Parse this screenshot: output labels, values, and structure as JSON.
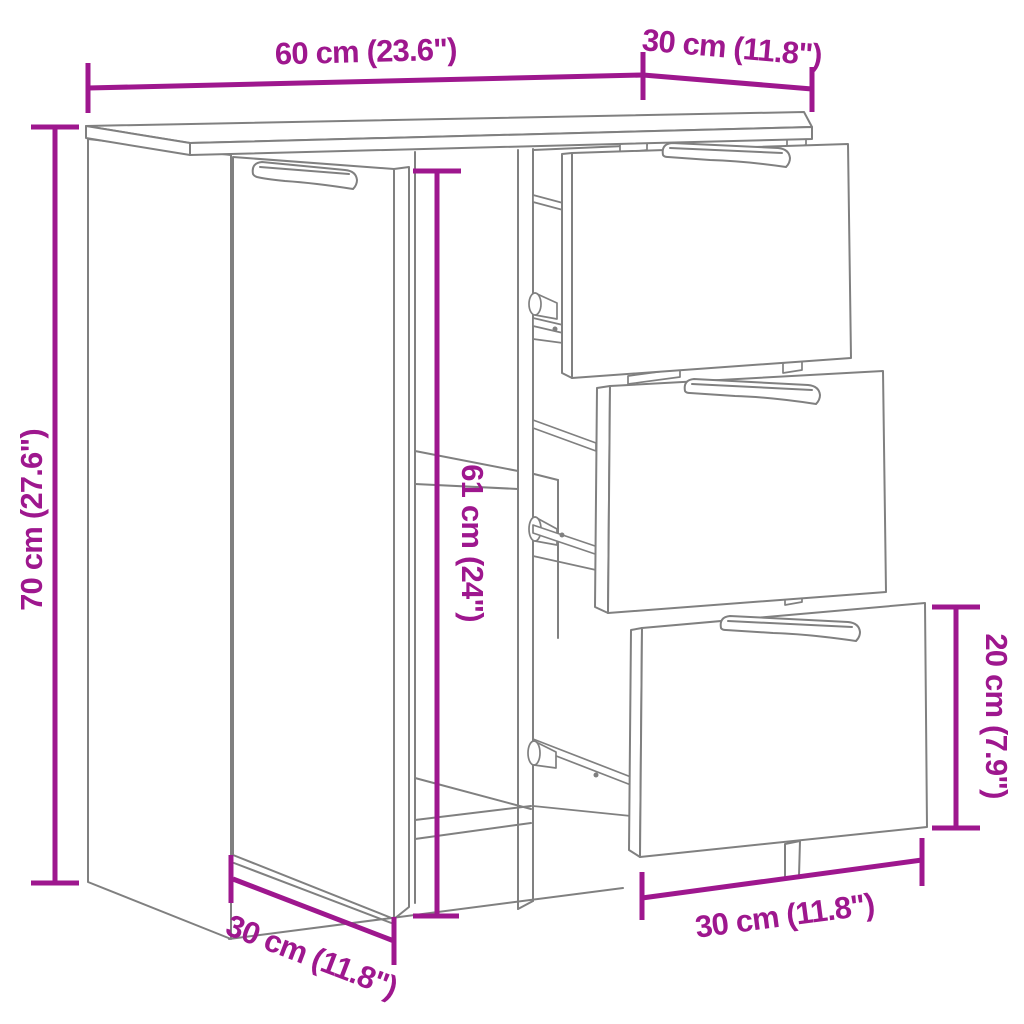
{
  "title": "Sideboard dimension diagram",
  "colors": {
    "dimension": "#9E178E",
    "outline": "#808080",
    "background": "#FFFFFF"
  },
  "dimensions": {
    "width": {
      "label": "60 cm (23.6\")"
    },
    "top_depth": {
      "label": "30 cm (11.8\")"
    },
    "height": {
      "label": "70 cm (27.6\")"
    },
    "interior_height": {
      "label": "61 cm (24\")"
    },
    "drawer_height": {
      "label": "20 cm (7.9\")"
    },
    "drawer_width": {
      "label": "30 cm (11.8\")"
    },
    "base_depth": {
      "label": "30 cm (11.8\")"
    }
  }
}
